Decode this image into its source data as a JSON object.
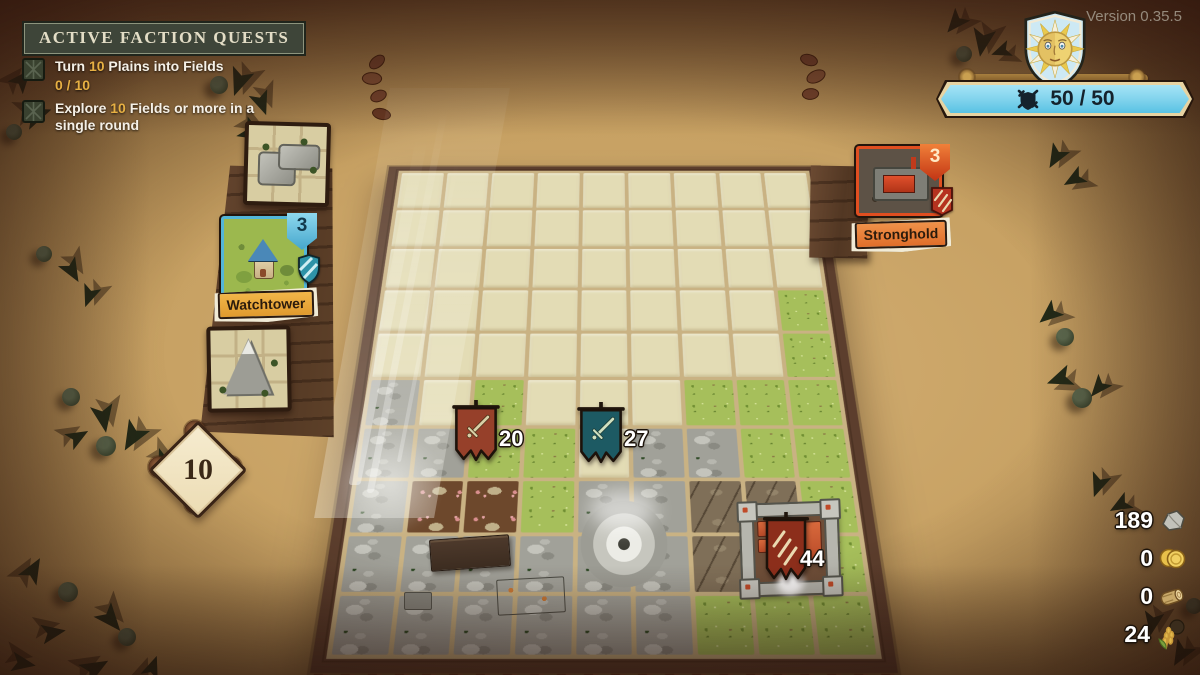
{
  "version_label": "Version 0.35.5",
  "hud": {
    "power_banner": {
      "value": "50 / 50",
      "icon": "shield-swords-icon",
      "fill": "#7ed2ec",
      "border": "#e7d3a2"
    },
    "sun_crest": {
      "icon": "sun-face-shield-icon"
    }
  },
  "quests_panel": {
    "title": "ACTIVE FACTION QUESTS",
    "number_color": "#e7b043",
    "items": [
      {
        "prefix": "Turn ",
        "number": "10",
        "suffix": " Plains into Fields",
        "progress": "0 / 10"
      },
      {
        "prefix": "Explore ",
        "number": "10",
        "suffix": " Fields or more in a single round",
        "progress": ""
      }
    ]
  },
  "hand": {
    "top_card": {
      "kind": "rocks-corner-tile"
    },
    "main_card": {
      "label": "Watchtower",
      "count": "3",
      "accent": "#53b6d8"
    },
    "bottom_card": {
      "kind": "mountain-tile"
    },
    "deck_counter": "10"
  },
  "enemy": {
    "card": {
      "label": "Stronghold",
      "count": "3",
      "accent": "#e04e20"
    }
  },
  "units": [
    {
      "name": "red-army",
      "value": "20",
      "flag_color": "#96402a"
    },
    {
      "name": "teal-army",
      "value": "27",
      "flag_color": "#1d5a63"
    },
    {
      "name": "stronghold-garrison",
      "value": "44",
      "flag_color": "#8c2e1b"
    }
  ],
  "resources": [
    {
      "name": "stone",
      "value": "189"
    },
    {
      "name": "gold",
      "value": "0"
    },
    {
      "name": "wood",
      "value": "0"
    },
    {
      "name": "wheat",
      "value": "24"
    }
  ],
  "board": {
    "cols": 9,
    "rows": 10,
    "tile_map": [
      "eeeeeeeee",
      "eeeeeeeee",
      "eeeeeeeee",
      "eeeeeeeeg",
      "eeeeeeeeg",
      "regeeeggg",
      "rrggerrgg",
      "rddgrrbbg",
      "rrrrrrbgg",
      "rrrrrrggg"
    ],
    "legend": {
      "e": {
        "name": "plains",
        "color": "#e3dcb5"
      },
      "g": {
        "name": "field-grass",
        "color": "#a6bf5b"
      },
      "r": {
        "name": "rocks",
        "color": "#a1a199"
      },
      "d": {
        "name": "dirt",
        "color": "#6d482c"
      },
      "b": {
        "name": "battlefield",
        "color": "#7f6f58"
      }
    }
  }
}
